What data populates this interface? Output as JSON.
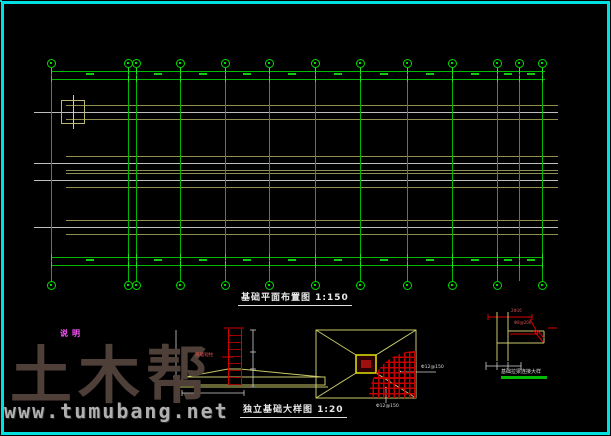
{
  "plan": {
    "title": "基础平面布置图 1:150",
    "grid_x": [
      51,
      128,
      136,
      180,
      225,
      269,
      315,
      360,
      407,
      452,
      497,
      519,
      542
    ],
    "footing_x": [
      73,
      100,
      132,
      180,
      225,
      269,
      315,
      360,
      407,
      452,
      497,
      519,
      542
    ],
    "rows_single": [
      112,
      227
    ],
    "band": {
      "center": 171,
      "height": 46,
      "col_rows": [
        163,
        180
      ]
    },
    "strip_x": [
      66,
      558
    ],
    "dim_top_y": [
      71,
      79
    ],
    "dim_bottom_y": [
      257,
      265
    ],
    "top_bubble_y": 63,
    "bottom_bubble_y": 285,
    "bottom_bubble_skip": 519,
    "left_bubbles": [
      [
        13,
        111
      ],
      [
        13,
        226
      ]
    ],
    "right_bubbles": [
      [
        601,
        110
      ],
      [
        601,
        161
      ],
      [
        601,
        174
      ],
      [
        601,
        228
      ]
    ]
  },
  "notes": {
    "title": "说明",
    "lines": [
      "一、本工程基础采用柱下独立基础，以粉质粘土层作为基础持力层。",
      "二、地基承载力特征值 fak=180kPa。",
      "三、基础混凝土强度等级为C25，垫层为C10素混凝土，厚100。",
      "四、基础底板钢筋保护层厚度为40mm，短柱保护层30mm。",
      "五、基础施工前应钎探验槽，持力层与设计不符时通知设计处理。",
      "六、基槽回填土须分层夯实，压实系数不小于0.94。",
      "七、基础拉梁详见拉梁配筋图，拉梁顶标高为-0.050。",
      "八、未尽事宜按国家现行规范及标准图集施工。"
    ]
  },
  "detail_section": {
    "title": "独立基础大样图 1:20",
    "column_label": "基础短柱"
  },
  "detail_plan": {
    "rebar_label_1": "Φ12@150",
    "rebar_label_2": "Φ12@150"
  },
  "detail_conn": {
    "title": "基础拉梁连接大样",
    "bar_top": "2Φ16",
    "bar_stirrup": "Φ8@200"
  },
  "watermark": {
    "brand": "土木帮",
    "site": "www.tumubang.net"
  },
  "titleblock": {
    "x": 473,
    "y": 397,
    "w": 135,
    "h": 35,
    "cells": [
      {
        "x": 0,
        "y": 0,
        "w": 64,
        "h": 10,
        "t": "土木帮建筑设计有限公司",
        "fs": 4.4
      },
      {
        "x": 64,
        "y": 0,
        "w": 16,
        "h": 10,
        "t": "审定",
        "fs": 4
      },
      {
        "x": 80,
        "y": 0,
        "w": 55,
        "h": 10,
        "t": "××中学教学楼工程",
        "fs": 4.4
      },
      {
        "x": 0,
        "y": 10,
        "w": 16,
        "h": 7,
        "t": "审核",
        "fs": 3.8
      },
      {
        "x": 16,
        "y": 10,
        "w": 48,
        "h": 7,
        "t": "专业负责人",
        "fs": 3.8
      },
      {
        "x": 64,
        "y": 10,
        "w": 16,
        "h": 7,
        "t": "设计号",
        "fs": 3.8
      },
      {
        "x": 80,
        "y": 10,
        "w": 55,
        "h": 7,
        "t": "结  施",
        "fs": 3.8
      },
      {
        "x": 0,
        "y": 17,
        "w": 16,
        "h": 9,
        "t": "设计",
        "fs": 3.8
      },
      {
        "x": 16,
        "y": 17,
        "w": 8,
        "h": 18,
        "t": "",
        "fs": 3.8
      },
      {
        "x": 0,
        "y": 26,
        "w": 16,
        "h": 9,
        "t": "制图",
        "fs": 3.8
      },
      {
        "x": 80,
        "y": 17,
        "w": 19,
        "h": 9,
        "t": "图别",
        "fs": 3.8
      },
      {
        "x": 99,
        "y": 17,
        "w": 17,
        "h": 9,
        "t": "结施",
        "fs": 3.8
      },
      {
        "x": 116,
        "y": 17,
        "w": 19,
        "h": 9,
        "t": "图号",
        "fs": 3.8
      },
      {
        "x": 80,
        "y": 26,
        "w": 19,
        "h": 9,
        "t": "比例",
        "fs": 3.8
      },
      {
        "x": 99,
        "y": 26,
        "w": 17,
        "h": 9,
        "t": "1:150",
        "fs": 3.8
      },
      {
        "x": 116,
        "y": 26,
        "w": 19,
        "h": 9,
        "t": "日期",
        "fs": 3.8
      }
    ],
    "name_box": {
      "x": 24,
      "y": 17,
      "w": 56,
      "h": 18,
      "lines": [
        "基础平面布置图",
        "独立基础大样图"
      ]
    }
  }
}
